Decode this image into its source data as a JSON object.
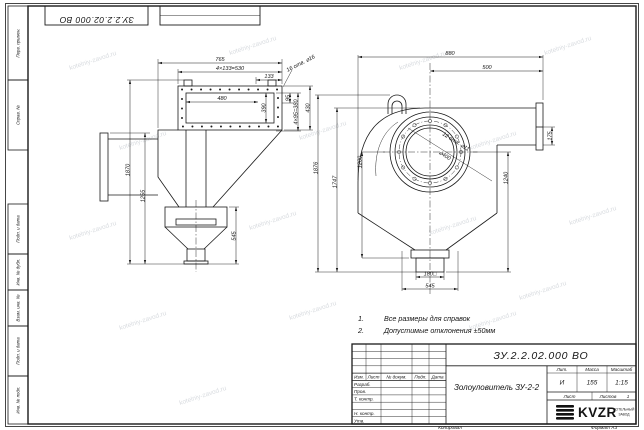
{
  "doc": {
    "number": "ЗУ.2.2.02.000 ВО",
    "title": "Золоуловитель ЗУ-2-2",
    "liter_label": "Лит.",
    "mass_label": "Масса",
    "scale_label": "Масштаб",
    "liter": "И",
    "mass": "155",
    "scale": "1:15",
    "sheet_label": "Лист",
    "sheets_label": "Листов",
    "sheets_value": "1",
    "copied_label": "Копировал",
    "format_label": "Формат А3",
    "company": {
      "logo": "KVZR",
      "line1": "КОТЕЛЬНЫЙ",
      "line2": "ЗАВОД"
    }
  },
  "title_block": {
    "cols": [
      "Изм.",
      "Лист",
      "№ докум.",
      "Подп.",
      "Дата"
    ],
    "rows": [
      "Разраб.",
      "Пров.",
      "Т. контр.",
      "Н. контр.",
      "Утв."
    ]
  },
  "margin_labels": {
    "top1": "Перв. примен.",
    "top2": "Справ. №",
    "b1": "Подп. и дата",
    "b2": "Инв. № дубл.",
    "b3": "Взам. инв. №",
    "b4": "Подп. и дата",
    "b5": "Инв. № подл."
  },
  "notes": {
    "n1_num": "1.",
    "n1": "Все размеры для справок",
    "n2_num": "2.",
    "n2": "Допустимые отклонения ±50мм"
  },
  "left_view": {
    "dim_width_overall": "765",
    "dim_bolt_pitch_h": "4×133=530",
    "dim_pitch_h": "133",
    "dim_opening_w": "480",
    "dim_opening_h": "390",
    "dim_holes_note": "16 отв. ⌀16",
    "dim_pitch_v1": "95",
    "dim_bolt_pitch_v": "4×95=380",
    "dim_flange_h": "430",
    "dim_height_overall": "1870",
    "dim_height_mid": "1255",
    "dim_height_lower": "545"
  },
  "right_view": {
    "dim_width_overall": "880",
    "dim_width_top": "500",
    "dim_height_overall": "1876",
    "dim_height_body": "1747",
    "dim_height_axis": "1200",
    "dim_height_right": "1240",
    "dim_duct": "175",
    "dim_holes_note": "12 отв. ⌀11",
    "dim_flange_dia": "⌀400",
    "dim_spout": "180□",
    "dim_width_bottom": "545"
  },
  "watermark": {
    "text": "kotelniy-zavod.ru"
  },
  "colors": {
    "line": "#1a1a1a",
    "watermark": "#d9dce0",
    "paper": "#ffffff"
  }
}
